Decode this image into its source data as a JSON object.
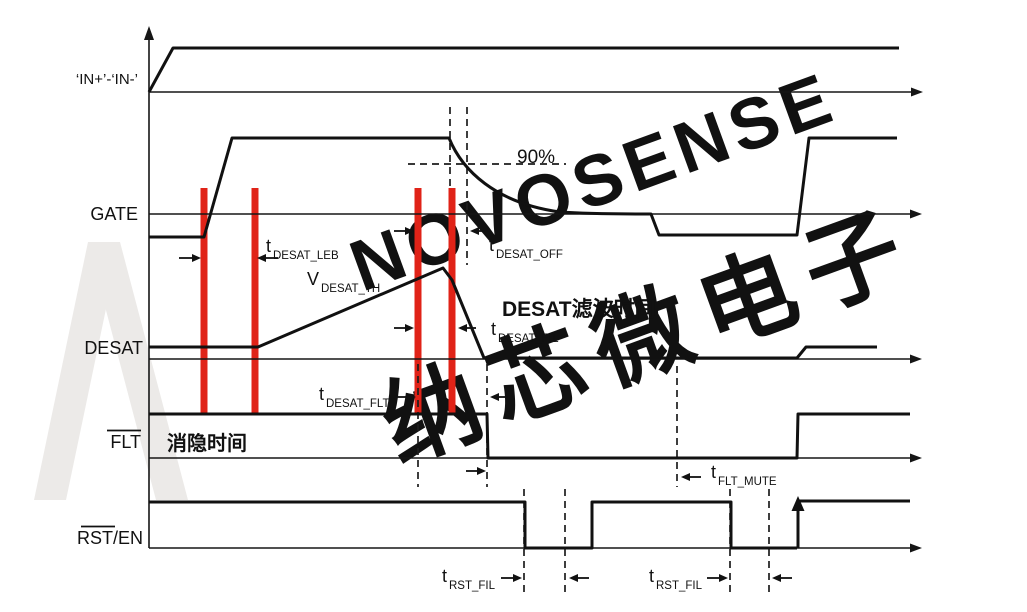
{
  "signals": {
    "in_plus_minus": "‘IN+’-‘IN-’",
    "gate": "GATE",
    "desat": "DESAT",
    "flt": "FLT",
    "rst_en": "RST/EN"
  },
  "annotations": {
    "pct90": "90%",
    "desat_filter_time_cn": "DESAT滤波时间",
    "blanking_time_cn": "消隐时间"
  },
  "timing": {
    "t_desat_leb": {
      "sym": "t",
      "sub": "DESAT_LEB"
    },
    "t_desat_off": {
      "sym": "t",
      "sub": "DESAT_OFF"
    },
    "v_desat_th": {
      "sym": "V",
      "sub": "DESAT_TH"
    },
    "t_desat_fil": {
      "sym": "t",
      "sub": "DESAT_FIL"
    },
    "t_desat_flt": {
      "sym": "t",
      "sub": "DESAT_FLT"
    },
    "t_flt_mute": {
      "sym": "t",
      "sub": "FLT_MUTE"
    },
    "t_rst_fil_1": {
      "sym": "t",
      "sub": "RST_FIL"
    },
    "t_rst_fil_2": {
      "sym": "t",
      "sub": "RST_FIL"
    }
  },
  "watermark": {
    "line1": "NOVOSENSE",
    "line2": "纳芯微电子"
  },
  "colors": {
    "line": "#161616",
    "red": "#e02318",
    "watermark": "#efedeb"
  }
}
